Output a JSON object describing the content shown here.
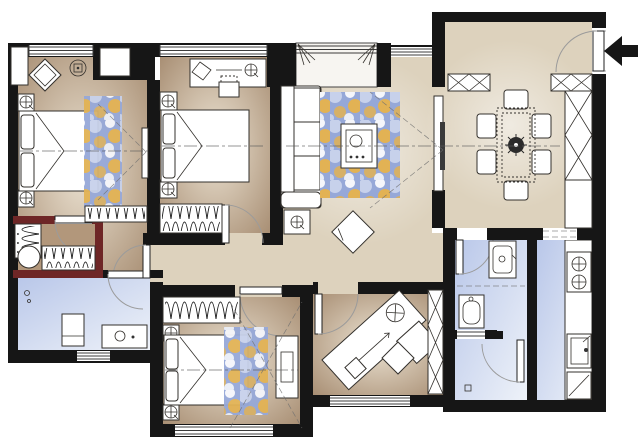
{
  "meta": {
    "title": "apartment-floor-plan",
    "canvas": {
      "width": 640,
      "height": 442
    }
  },
  "palette": {
    "wall": "#161616",
    "accentWall": "#6e2626",
    "floorOpen": "#ddd2bd",
    "floorRoomCenter": "#ece3d3",
    "floorRoomEdge": "#a78d72",
    "floorCloset": "#b2977b",
    "wetBlue": "#b9c7e9",
    "wetLight": "#eef2f9",
    "balcony": "#f7f5f1",
    "rugBlue": "#96a8d8",
    "rugGold": "#e2b254",
    "rugLight": "#c7d1eb",
    "line": "#33302c",
    "white": "#ffffff"
  },
  "entry": {
    "arrow_icon": "entry-arrow",
    "direction": "points-left-into-entry-door"
  },
  "rooms": [
    {
      "id": "master-bedroom",
      "position": "top-left",
      "items": [
        "double-bed",
        "pillows",
        "blanket-fold",
        "area-rug",
        "nightstand-lamp",
        "nightstand-lamp",
        "decor-diamond-table",
        "ceiling-lamp-icon",
        "hanging-wardrobe",
        "wall-tv",
        "window"
      ]
    },
    {
      "id": "bedroom-2",
      "position": "top-middle",
      "items": [
        "double-bed",
        "pillows",
        "desk",
        "desk-chair",
        "desk-lamp-icon",
        "nightstand-lamp",
        "nightstand-lamp",
        "hanging-wardrobe",
        "window"
      ]
    },
    {
      "id": "balcony-bay",
      "position": "top-center",
      "items": [
        "window-band",
        "curtain-icon",
        "curtain-icon"
      ]
    },
    {
      "id": "living-room",
      "position": "center",
      "items": [
        "sectional-sofa",
        "side-table-lamp",
        "area-rug",
        "coffee-table",
        "floor-cushion-diamond",
        "tv-panel",
        "sight-lines"
      ]
    },
    {
      "id": "dining-room",
      "position": "top-right",
      "items": [
        "dining-table",
        "centerpiece-plant-icon",
        "chair",
        "chair",
        "chair",
        "chair",
        "chair",
        "chair",
        "sideboard-x-cabinet",
        "sideboard-x-cabinet",
        "tall-x-cabinet",
        "low-cabinet"
      ]
    },
    {
      "id": "entry",
      "position": "right-top",
      "items": [
        "entry-door",
        "entry-arrow-icon"
      ]
    },
    {
      "id": "walk-in-closet",
      "position": "left-middle",
      "accent": "maroon-walls",
      "items": [
        "hanging-rail",
        "hanging-rail",
        "stool-circle",
        "door"
      ]
    },
    {
      "id": "bathroom-1",
      "position": "bottom-left",
      "items": [
        "vanity-sink",
        "cabinet-washer",
        "faucet-dots",
        "door",
        "window"
      ]
    },
    {
      "id": "hallway",
      "position": "middle",
      "items": [
        "corridor-floor"
      ]
    },
    {
      "id": "bedroom-3",
      "position": "bottom-middle",
      "items": [
        "double-bed",
        "pillows",
        "area-rug",
        "nightstand-lamp",
        "nightstand-lamp",
        "hanging-wardrobe",
        "tv-cabinet",
        "sight-lines",
        "window",
        "door"
      ]
    },
    {
      "id": "study",
      "position": "bottom-center-right",
      "items": [
        "angled-desk",
        "desk-lamp-icon",
        "pen-line",
        "return-unit",
        "chair-diamond",
        "bookshelf-x",
        "door",
        "window"
      ]
    },
    {
      "id": "bathroom-2",
      "position": "right-middle",
      "items": [
        "vanity-sink",
        "toilet",
        "partition-vent",
        "shower-door",
        "floor-drain"
      ]
    },
    {
      "id": "kitchen",
      "position": "right-bottom",
      "items": [
        "counter",
        "stove-two-burners-icon",
        "kitchen-sink",
        "corner-unit",
        "cased-opening-dashed"
      ]
    }
  ]
}
